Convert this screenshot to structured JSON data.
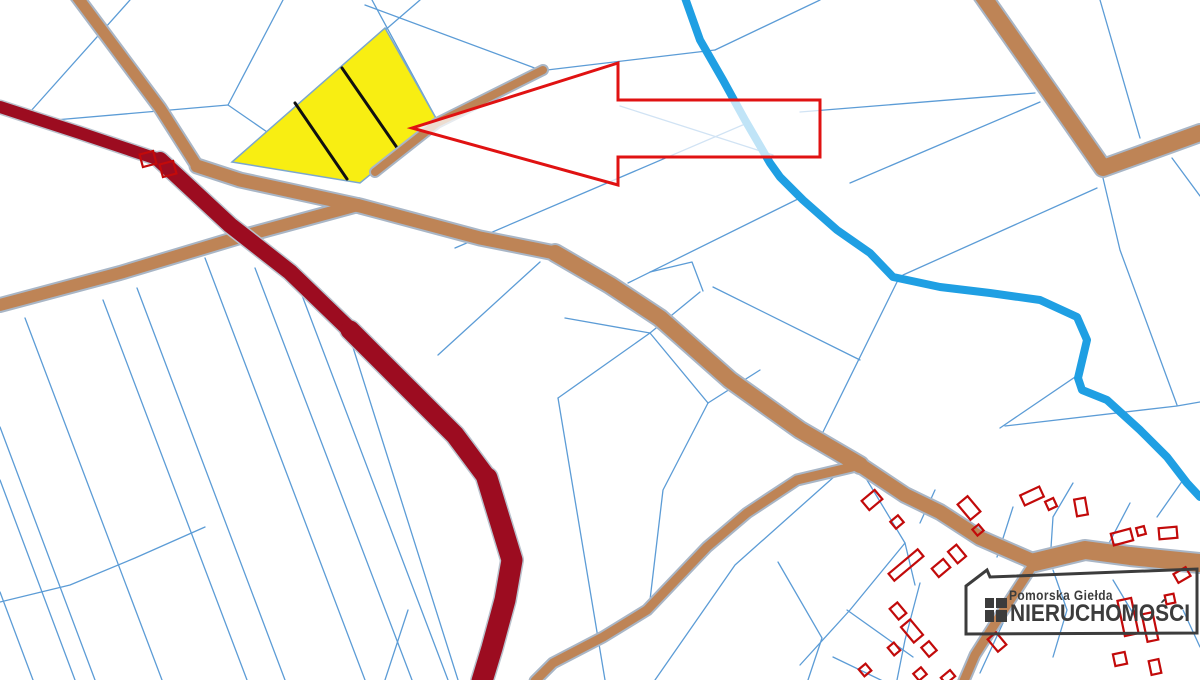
{
  "map": {
    "title": "cadastral-parcel-map",
    "colors": {
      "background": "#ffffff",
      "parcel_line": "#5c9cd6",
      "road_fill": "#be8456",
      "road_casing": "#a9b6c6",
      "highway_fill": "#9c0c20",
      "highway_casing": "#b9c2cd",
      "stream": "#1f9fe3",
      "highlight_parcel_fill": "#f8ee12",
      "highlight_parcel_stroke": "#7ba7cf",
      "divider": "#101010",
      "building_outline": "#c20a0a",
      "arrow_stroke": "#e01212",
      "arrow_fill": "rgba(255,255,255,0.72)",
      "logo": "#3c3c3c"
    },
    "parcel_lines": [
      [
        130,
        0,
        30,
        112
      ],
      [
        283,
        0,
        228,
        105
      ],
      [
        228,
        105,
        55,
        120
      ],
      [
        228,
        105,
        312,
        163
      ],
      [
        232,
        162,
        420,
        0
      ],
      [
        437,
        120,
        372,
        0
      ],
      [
        365,
        5,
        540,
        70
      ],
      [
        547,
        70,
        715,
        50
      ],
      [
        820,
        0,
        715,
        50
      ],
      [
        620,
        106,
        773,
        155
      ],
      [
        455,
        248,
        745,
        124
      ],
      [
        628,
        283,
        800,
        198
      ],
      [
        650,
        272,
        692,
        262,
        703,
        291
      ],
      [
        650,
        333,
        700,
        292
      ],
      [
        565,
        318,
        650,
        333
      ],
      [
        713,
        287,
        860,
        360
      ],
      [
        897,
        282,
        822,
        434
      ],
      [
        850,
        183,
        1040,
        102
      ],
      [
        800,
        112,
        1035,
        93
      ],
      [
        1100,
        0,
        1140,
        138
      ],
      [
        1103,
        178,
        1120,
        250,
        1177,
        405
      ],
      [
        1097,
        188,
        903,
        275
      ],
      [
        1172,
        158,
        1200,
        196
      ],
      [
        1078,
        375,
        1000,
        428
      ],
      [
        1005,
        426,
        1177,
        406,
        1200,
        402
      ],
      [
        540,
        262,
        438,
        355
      ],
      [
        650,
        333,
        558,
        398
      ],
      [
        650,
        333,
        708,
        403
      ],
      [
        558,
        398,
        605,
        680
      ],
      [
        708,
        403,
        663,
        490,
        650,
        600
      ],
      [
        708,
        403,
        760,
        370
      ],
      [
        408,
        610,
        385,
        680
      ],
      [
        0,
        427,
        95,
        680
      ],
      [
        0,
        480,
        75,
        680
      ],
      [
        0,
        592,
        33,
        680
      ],
      [
        25,
        318,
        162,
        680
      ],
      [
        103,
        300,
        247,
        680
      ],
      [
        137,
        288,
        285,
        680
      ],
      [
        205,
        258,
        365,
        680
      ],
      [
        255,
        268,
        412,
        680
      ],
      [
        300,
        290,
        448,
        680
      ],
      [
        345,
        322,
        458,
        680
      ],
      [
        0,
        602,
        70,
        585,
        135,
        558,
        205,
        527
      ],
      [
        845,
        467,
        735,
        565,
        655,
        680
      ],
      [
        867,
        480,
        905,
        543,
        915,
        585
      ],
      [
        905,
        543,
        850,
        610,
        800,
        665
      ],
      [
        778,
        562,
        822,
        638,
        808,
        680
      ],
      [
        1073,
        483,
        1053,
        517,
        1050,
        563
      ],
      [
        1130,
        503,
        1107,
        547
      ],
      [
        1183,
        480,
        1157,
        517
      ],
      [
        935,
        490,
        920,
        523
      ],
      [
        1013,
        507,
        997,
        557
      ],
      [
        847,
        610,
        913,
        657
      ],
      [
        833,
        657,
        887,
        683
      ],
      [
        1003,
        623,
        980,
        673
      ],
      [
        1053,
        570,
        1067,
        610,
        1053,
        657
      ],
      [
        1113,
        580,
        1137,
        620
      ],
      [
        1183,
        610,
        1200,
        647
      ],
      [
        920,
        583,
        905,
        640,
        897,
        680
      ]
    ],
    "roads": [
      {
        "pts": [
          75,
          -6,
          160,
          108,
          197,
          166
        ],
        "w": 11
      },
      {
        "pts": [
          197,
          166,
          240,
          180,
          300,
          193,
          360,
          206,
          420,
          222,
          480,
          238,
          555,
          253
        ],
        "w": 13
      },
      {
        "pts": [
          555,
          253,
          610,
          285,
          660,
          318,
          730,
          380,
          800,
          430,
          860,
          465
        ],
        "w": 16
      },
      {
        "pts": [
          860,
          465,
          905,
          495,
          940,
          512,
          980,
          538,
          1035,
          562
        ],
        "w": 14
      },
      {
        "pts": [
          1035,
          562,
          1085,
          550,
          1130,
          556,
          1200,
          563
        ],
        "w": 18
      },
      {
        "pts": [
          1035,
          562,
          1005,
          608,
          975,
          655,
          963,
          683
        ],
        "w": 9
      },
      {
        "pts": [
          852,
          467,
          797,
          480,
          747,
          513,
          707,
          547,
          647,
          610,
          603,
          637,
          553,
          663,
          535,
          681
        ],
        "w": 9
      },
      {
        "pts": [
          358,
          205,
          240,
          237,
          120,
          273,
          0,
          305
        ],
        "w": 12
      },
      {
        "pts": [
          375,
          172,
          437,
          123,
          543,
          70
        ],
        "w": 8
      },
      {
        "pts": [
          982,
          -5,
          1050,
          92,
          1103,
          168,
          1200,
          133
        ],
        "w": 16
      }
    ],
    "highways": [
      {
        "pts": [
          0,
          107,
          80,
          133,
          160,
          160
        ],
        "w": 12
      },
      {
        "pts": [
          160,
          160,
          230,
          225,
          290,
          272,
          350,
          330
        ],
        "w": 16
      },
      {
        "pts": [
          350,
          330,
          410,
          390,
          455,
          435,
          487,
          478
        ],
        "w": 19
      },
      {
        "pts": [
          487,
          478,
          512,
          560,
          505,
          600,
          492,
          648,
          482,
          681
        ],
        "w": 21
      }
    ],
    "stream": {
      "pts": [
        684,
        -5,
        700,
        40,
        723,
        80,
        745,
        120,
        770,
        163,
        780,
        177,
        803,
        200,
        837,
        230,
        870,
        253,
        893,
        277,
        940,
        287,
        990,
        293,
        1040,
        300,
        1077,
        317,
        1087,
        340,
        1078,
        378,
        1082,
        390,
        1107,
        400,
        1140,
        430,
        1167,
        457,
        1187,
        483,
        1200,
        497
      ],
      "w": 8
    },
    "highlight_parcel": {
      "outline": [
        385,
        28,
        437,
        120,
        360,
        183,
        232,
        162
      ],
      "dividers": [
        [
          295,
          103,
          347,
          179
        ],
        [
          342,
          68,
          400,
          152
        ]
      ]
    },
    "buildings": [
      [
        148,
        159,
        14,
        13,
        -15
      ],
      [
        168,
        169,
        14,
        13,
        -15
      ],
      [
        872,
        500,
        17,
        12,
        -40
      ],
      [
        897,
        522,
        10,
        9,
        -40
      ],
      [
        906,
        565,
        38,
        9,
        -40
      ],
      [
        941,
        568,
        15,
        11,
        -40
      ],
      [
        957,
        554,
        11,
        15,
        -40
      ],
      [
        969,
        508,
        13,
        20,
        -40
      ],
      [
        978,
        530,
        8,
        8,
        -40
      ],
      [
        1032,
        496,
        21,
        11,
        -25
      ],
      [
        1051,
        504,
        9,
        9,
        -25
      ],
      [
        1081,
        507,
        11,
        17,
        -10
      ],
      [
        1122,
        537,
        20,
        12,
        -15
      ],
      [
        1141,
        531,
        8,
        8,
        -15
      ],
      [
        1168,
        533,
        18,
        11,
        -5
      ],
      [
        1182,
        575,
        14,
        10,
        -30
      ],
      [
        898,
        611,
        10,
        14,
        -40
      ],
      [
        912,
        631,
        12,
        20,
        -40
      ],
      [
        929,
        649,
        10,
        12,
        -40
      ],
      [
        894,
        649,
        8,
        10,
        -40
      ],
      [
        865,
        670,
        9,
        9,
        -40
      ],
      [
        920,
        674,
        10,
        9,
        -40
      ],
      [
        948,
        677,
        12,
        8,
        -40
      ],
      [
        997,
        642,
        11,
        16,
        -40
      ],
      [
        1128,
        617,
        14,
        36,
        -12
      ],
      [
        1150,
        627,
        11,
        28,
        -12
      ],
      [
        1170,
        599,
        9,
        9,
        -12
      ],
      [
        1120,
        659,
        12,
        12,
        -12
      ],
      [
        1155,
        667,
        10,
        14,
        -12
      ]
    ],
    "arrow": {
      "pts": [
        412,
        128,
        618,
        63,
        618,
        100,
        820,
        100,
        820,
        157,
        618,
        157,
        618,
        185
      ]
    },
    "logo": {
      "line1": "Pomorska Giełda",
      "line2": "NIERUCHOMOŚCI",
      "frame": [
        966,
        634,
        966,
        586,
        987,
        570,
        990,
        577,
        1197,
        569,
        1197,
        633
      ],
      "icon_rects": [
        [
          985,
          598,
          9,
          10
        ],
        [
          996,
          598,
          11,
          10
        ],
        [
          985,
          610,
          9,
          12
        ],
        [
          996,
          610,
          11,
          12
        ]
      ]
    }
  }
}
